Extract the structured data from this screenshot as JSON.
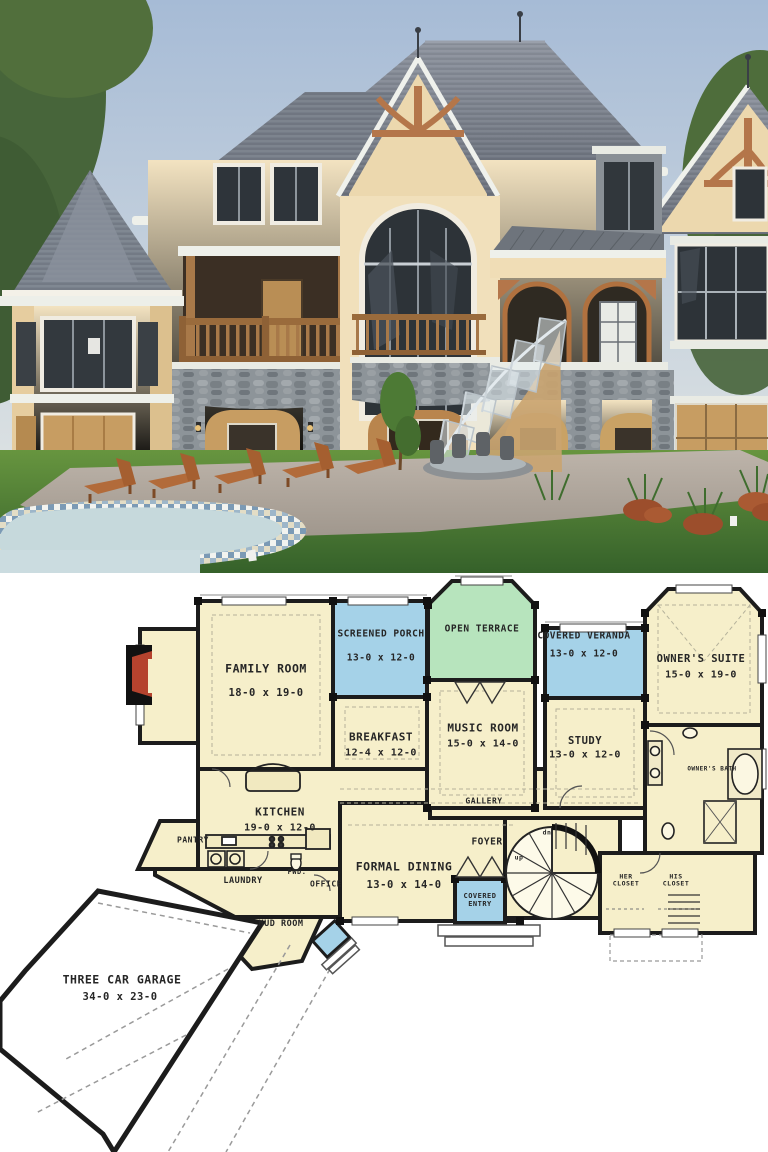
{
  "image": {
    "kind": "architectural pin: exterior rendering above first-floor plan",
    "width": 768,
    "height": 1152
  },
  "colors": {
    "room_cream": "#f6efca",
    "porch_blue": "#a5d2e8",
    "terrace_green": "#b7e4bd",
    "garage_white": "#ffffff",
    "wall_black": "#1c1c1c",
    "fireplace_red": "#b5432e",
    "plan_text": "#262626"
  },
  "floor_plan": {
    "rooms": [
      {
        "id": "family_room",
        "label": "FAMILY ROOM",
        "size": "18-0 x 19-0"
      },
      {
        "id": "screened_porch",
        "label": "SCREENED PORCH",
        "size": "13-0 x 12-0"
      },
      {
        "id": "open_terrace",
        "label": "OPEN TERRACE",
        "size": ""
      },
      {
        "id": "covered_veranda",
        "label": "COVERED VERANDA",
        "size": "13-0 x 12-0"
      },
      {
        "id": "owners_suite",
        "label": "OWNER'S SUITE",
        "size": "15-0 x 19-0"
      },
      {
        "id": "breakfast",
        "label": "BREAKFAST",
        "size": "12-4 x 12-0"
      },
      {
        "id": "music_room",
        "label": "MUSIC ROOM",
        "size": "15-0 x 14-0"
      },
      {
        "id": "study",
        "label": "STUDY",
        "size": "13-0 x 12-0"
      },
      {
        "id": "owners_bath",
        "label": "OWNER'S BATH",
        "size": ""
      },
      {
        "id": "kitchen",
        "label": "KITCHEN",
        "size": "19-0 x 12-0"
      },
      {
        "id": "gallery",
        "label": "GALLERY",
        "size": ""
      },
      {
        "id": "foyer",
        "label": "FOYER",
        "size": ""
      },
      {
        "id": "pantry",
        "label": "PANTRY",
        "size": ""
      },
      {
        "id": "laundry",
        "label": "LAUNDRY",
        "size": ""
      },
      {
        "id": "powder",
        "label": "PWD.",
        "size": ""
      },
      {
        "id": "office",
        "label": "OFFICE",
        "size": ""
      },
      {
        "id": "formal_dining",
        "label": "FORMAL DINING",
        "size": "13-0 x 14-0"
      },
      {
        "id": "covered_entry",
        "label": "COVERED ENTRY",
        "size": ""
      },
      {
        "id": "her_closet",
        "label": "HER CLOSET",
        "size": ""
      },
      {
        "id": "his_closet",
        "label": "HIS CLOSET",
        "size": ""
      },
      {
        "id": "mud_room",
        "label": "MUD ROOM",
        "size": ""
      },
      {
        "id": "garage",
        "label": "THREE CAR GARAGE",
        "size": "34-0 x 23-0"
      }
    ],
    "annotations": [
      {
        "id": "stair_up",
        "label": "up"
      },
      {
        "id": "stair_dn",
        "label": "dn"
      }
    ]
  }
}
